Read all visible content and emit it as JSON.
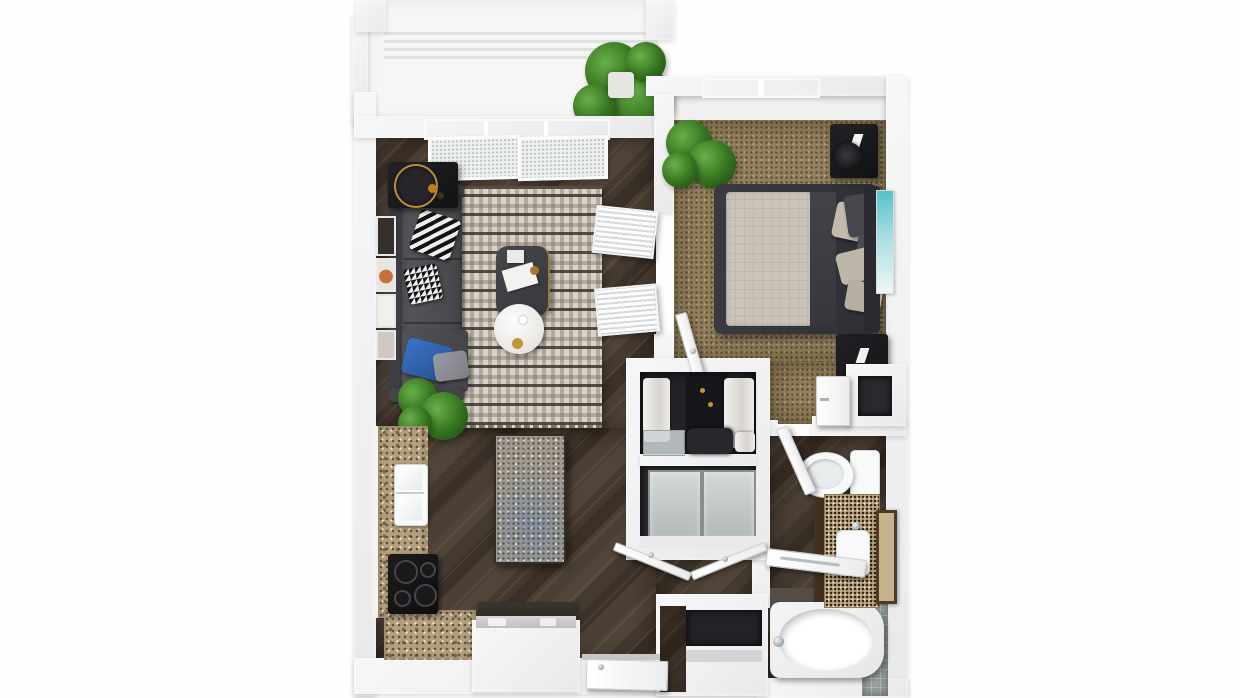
{
  "scene": {
    "description": "3D top-down rendering of a one-bedroom, one-bath apartment floor plan with balcony",
    "background_color": "#ffffff"
  },
  "palette": {
    "walls": "#f3f3f4",
    "wood_floor": "#473b31",
    "bedroom_carpet": "#93825f",
    "granite_counter": "#b2a081",
    "rug_base": "#d8d2c9",
    "sofa_gray": "#4a4a4f",
    "accent_pillow_blue": "#2f62b5",
    "plant_green": "#35721f",
    "teal_artwork": "#5cc3cd",
    "fixture_white": "#f8f9f9",
    "tile_gray": "#97a09a"
  },
  "rooms": {
    "balcony": {
      "label": "Balcony",
      "items": [
        "pergola slats",
        "potted palm"
      ]
    },
    "living_room": {
      "label": "Living room",
      "items": [
        "sectional sofa",
        "patterned area rug",
        "coffee table",
        "round marble side table",
        "bar-cart side table",
        "throw pillows",
        "floor plant",
        "gallery wall frames",
        "louvered double doors",
        "sliding glass door"
      ]
    },
    "bedroom": {
      "label": "Bedroom",
      "items": [
        "platform bed",
        "beige bedding",
        "throw pillows",
        "speaker nightstands",
        "window",
        "potted plant",
        "teal wall art",
        "open door"
      ]
    },
    "closet": {
      "label": "Walk-in closet",
      "items": [
        "hanging clothes",
        "storage box",
        "drawer unit"
      ]
    },
    "laundry_closet": {
      "label": "Laundry closet",
      "items": [
        "frosted double doors",
        "open bifold doors"
      ]
    },
    "kitchen": {
      "label": "Kitchen",
      "items": [
        "L-shaped granite counter",
        "double-basin sink",
        "black cooktop",
        "granite island table",
        "console counter"
      ]
    },
    "hallway": {
      "label": "Entry hallway",
      "items": [
        "entry door",
        "built-in niche with shelf"
      ]
    },
    "bathroom": {
      "label": "Bathroom",
      "items": [
        "toilet",
        "granite vanity with sink",
        "leaning framed mirror",
        "bathtub",
        "gray tile surround",
        "open door"
      ]
    }
  }
}
